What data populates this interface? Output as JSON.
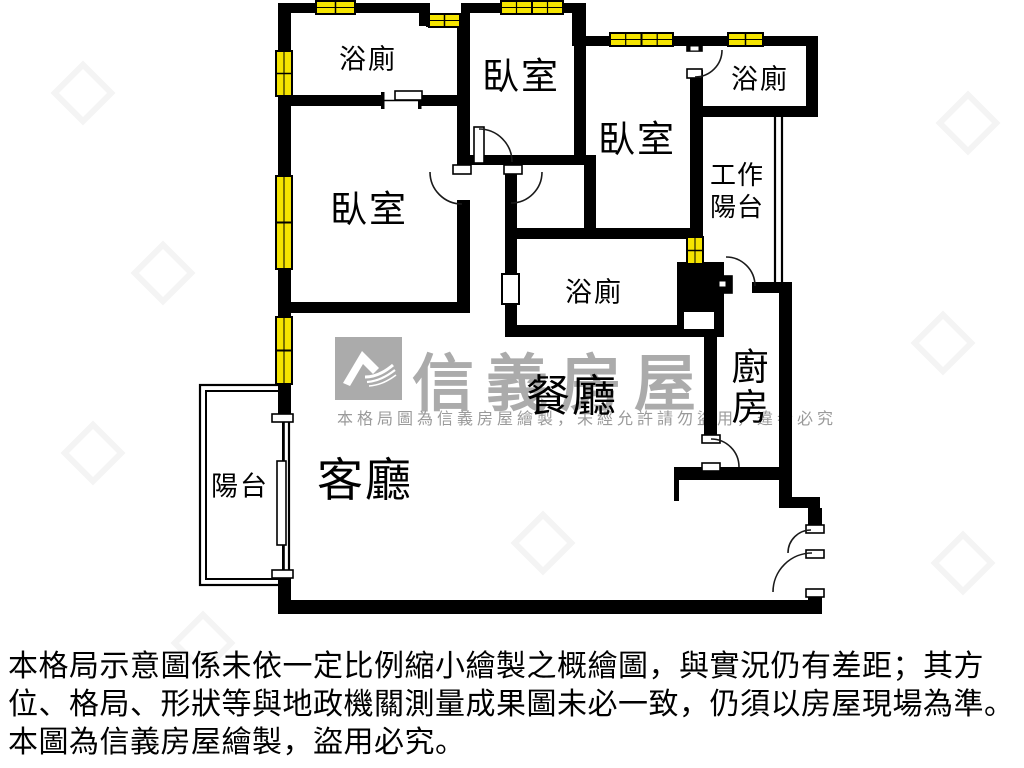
{
  "rooms": {
    "bathroom_top_left": "浴廁",
    "bedroom_top_center": "臥室",
    "bedroom_right": "臥室",
    "bathroom_top_right": "浴廁",
    "work_balcony_line1": "工作",
    "work_balcony_line2": "陽台",
    "bedroom_left": "臥室",
    "bathroom_center": "浴廁",
    "kitchen_char1": "廚",
    "kitchen_char2": "房",
    "dining": "餐廳",
    "living": "客廳",
    "balcony": "陽台"
  },
  "watermark": {
    "brand": "信義房屋",
    "tagline": "本格局圖為信義房屋繪製，未經允許請勿盜用，違者必究"
  },
  "disclaimer": {
    "line1": "本格局示意圖係未依一定比例縮小繪製之概繪圖，與實況仍有差距；其方",
    "line2": "位、格局、形狀等與地政機關測量成果圖未必一致，仍須以房屋現場為準。",
    "line3": "本圖為信義房屋繪製，盜用必究。"
  },
  "colors": {
    "wall": "#000000",
    "window_fill": "#f5e400",
    "watermark_gray": "#ababab"
  }
}
